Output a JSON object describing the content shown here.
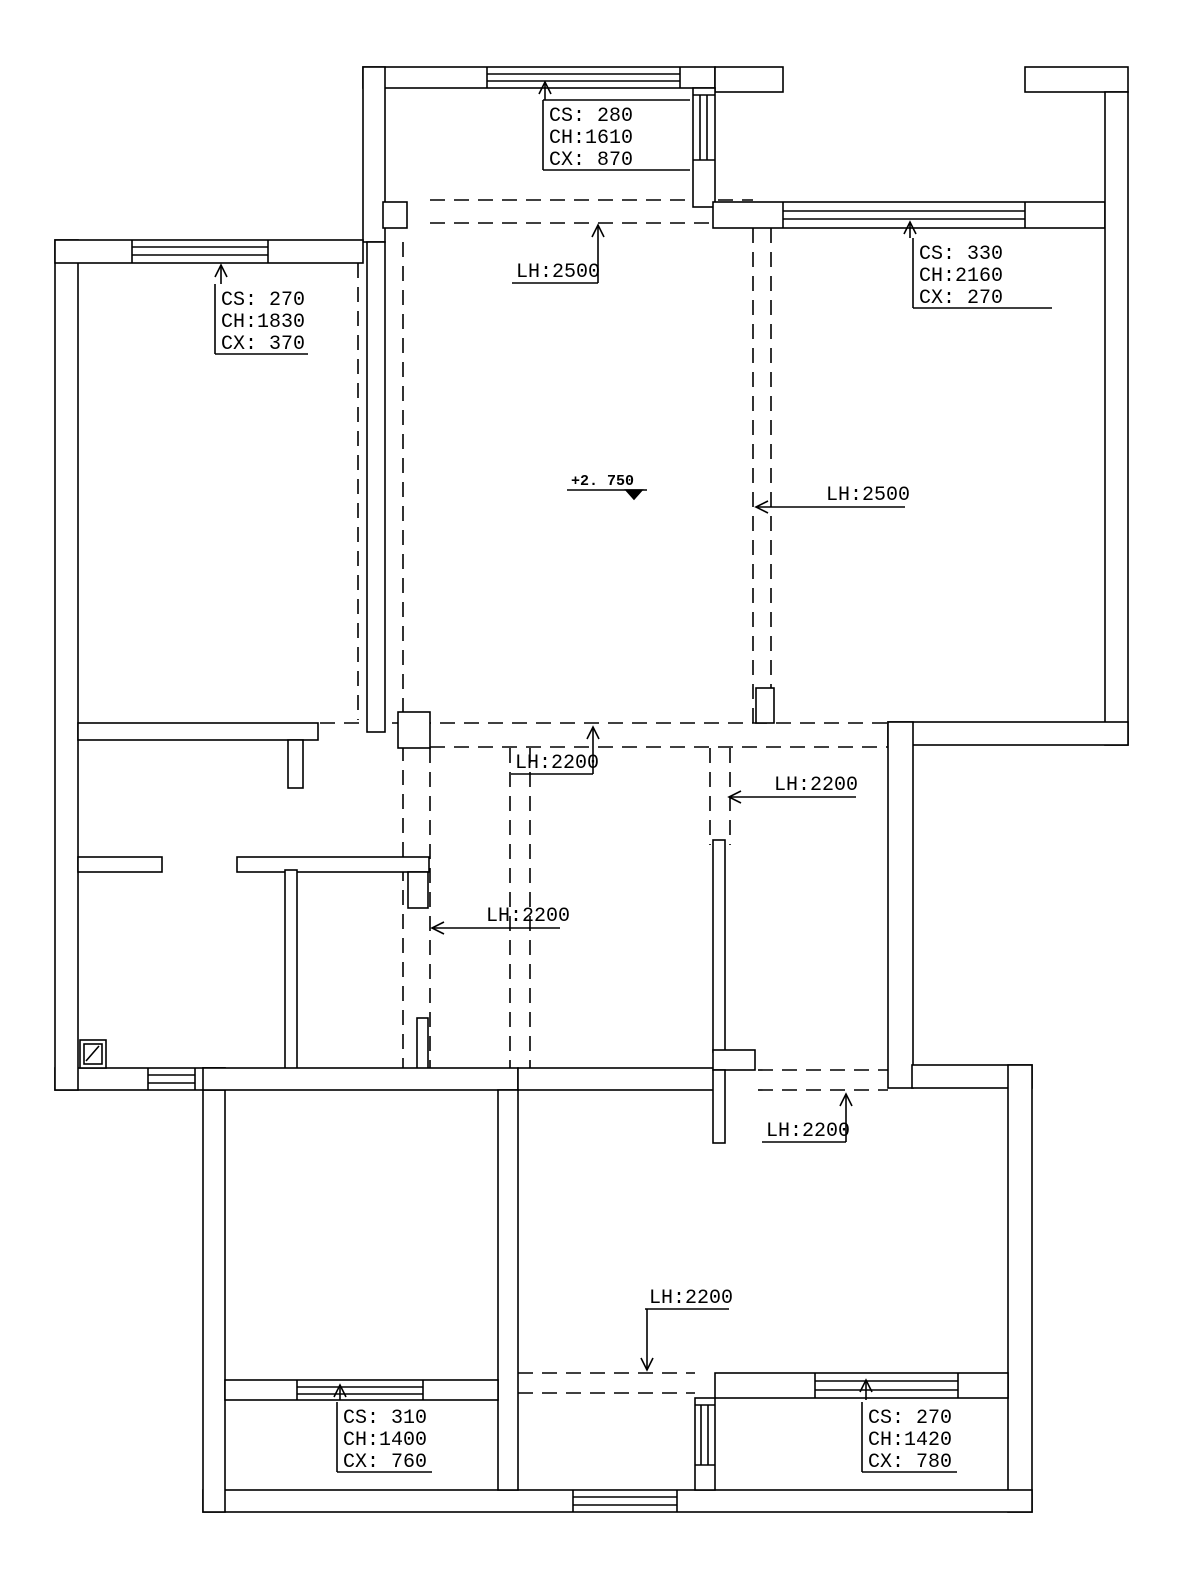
{
  "drawing": {
    "type": "floor-plan-ceiling-plan",
    "line_color": "#000000",
    "background": "#ffffff"
  },
  "labels": {
    "win_top_center": {
      "cs": "CS: 280",
      "ch": "CH:1610",
      "cx": "CX: 870"
    },
    "win_top_right": {
      "cs": "CS: 330",
      "ch": "CH:2160",
      "cx": "CX: 270"
    },
    "win_left": {
      "cs": "CS: 270",
      "ch": "CH:1830",
      "cx": "CX: 370"
    },
    "win_bottom_left": {
      "cs": "CS: 310",
      "ch": "CH:1400",
      "cx": "CX: 760"
    },
    "win_bottom_right": {
      "cs": "CS: 270",
      "ch": "CH:1420",
      "cx": "CX: 780"
    },
    "lh_top": "LH:2500",
    "lh_right": "LH:2500",
    "lh_center": "LH:2200",
    "lh_center_right": "LH:2200",
    "lh_center_left": "LH:2200",
    "lh_lower_right": "LH:2200",
    "lh_bottom": "LH:2200",
    "elevation": "+2. 750"
  }
}
